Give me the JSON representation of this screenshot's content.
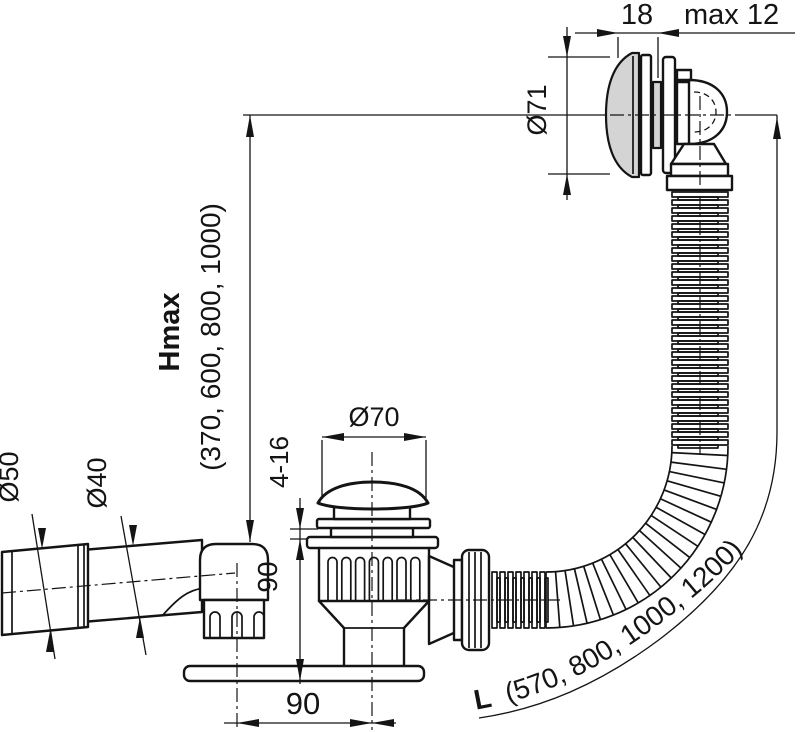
{
  "drawing_title": "bath waste, overflow and filling set - dimension drawing",
  "colors": {
    "line": "#141414",
    "shade": "#d4d4d4",
    "background": "#ffffff"
  },
  "annotations": {
    "overflow_width": "18",
    "overflow_wall_thickness": "max 12",
    "overflow_cap_diameter": "Ø71",
    "height_max_label": "Hmax",
    "height_max_values": "(370, 600, 800, 1000)",
    "outlet_socket_diameter": "Ø50",
    "outlet_pipe_diameter": "Ø40",
    "drain_cap_diameter": "Ø70",
    "tub_clamp_range": "4-16",
    "drain_body_height": "90",
    "drain_outlet_offset": "90",
    "hose_length_label": "L",
    "hose_length_values": "(570, 800, 1000, 1200)"
  }
}
